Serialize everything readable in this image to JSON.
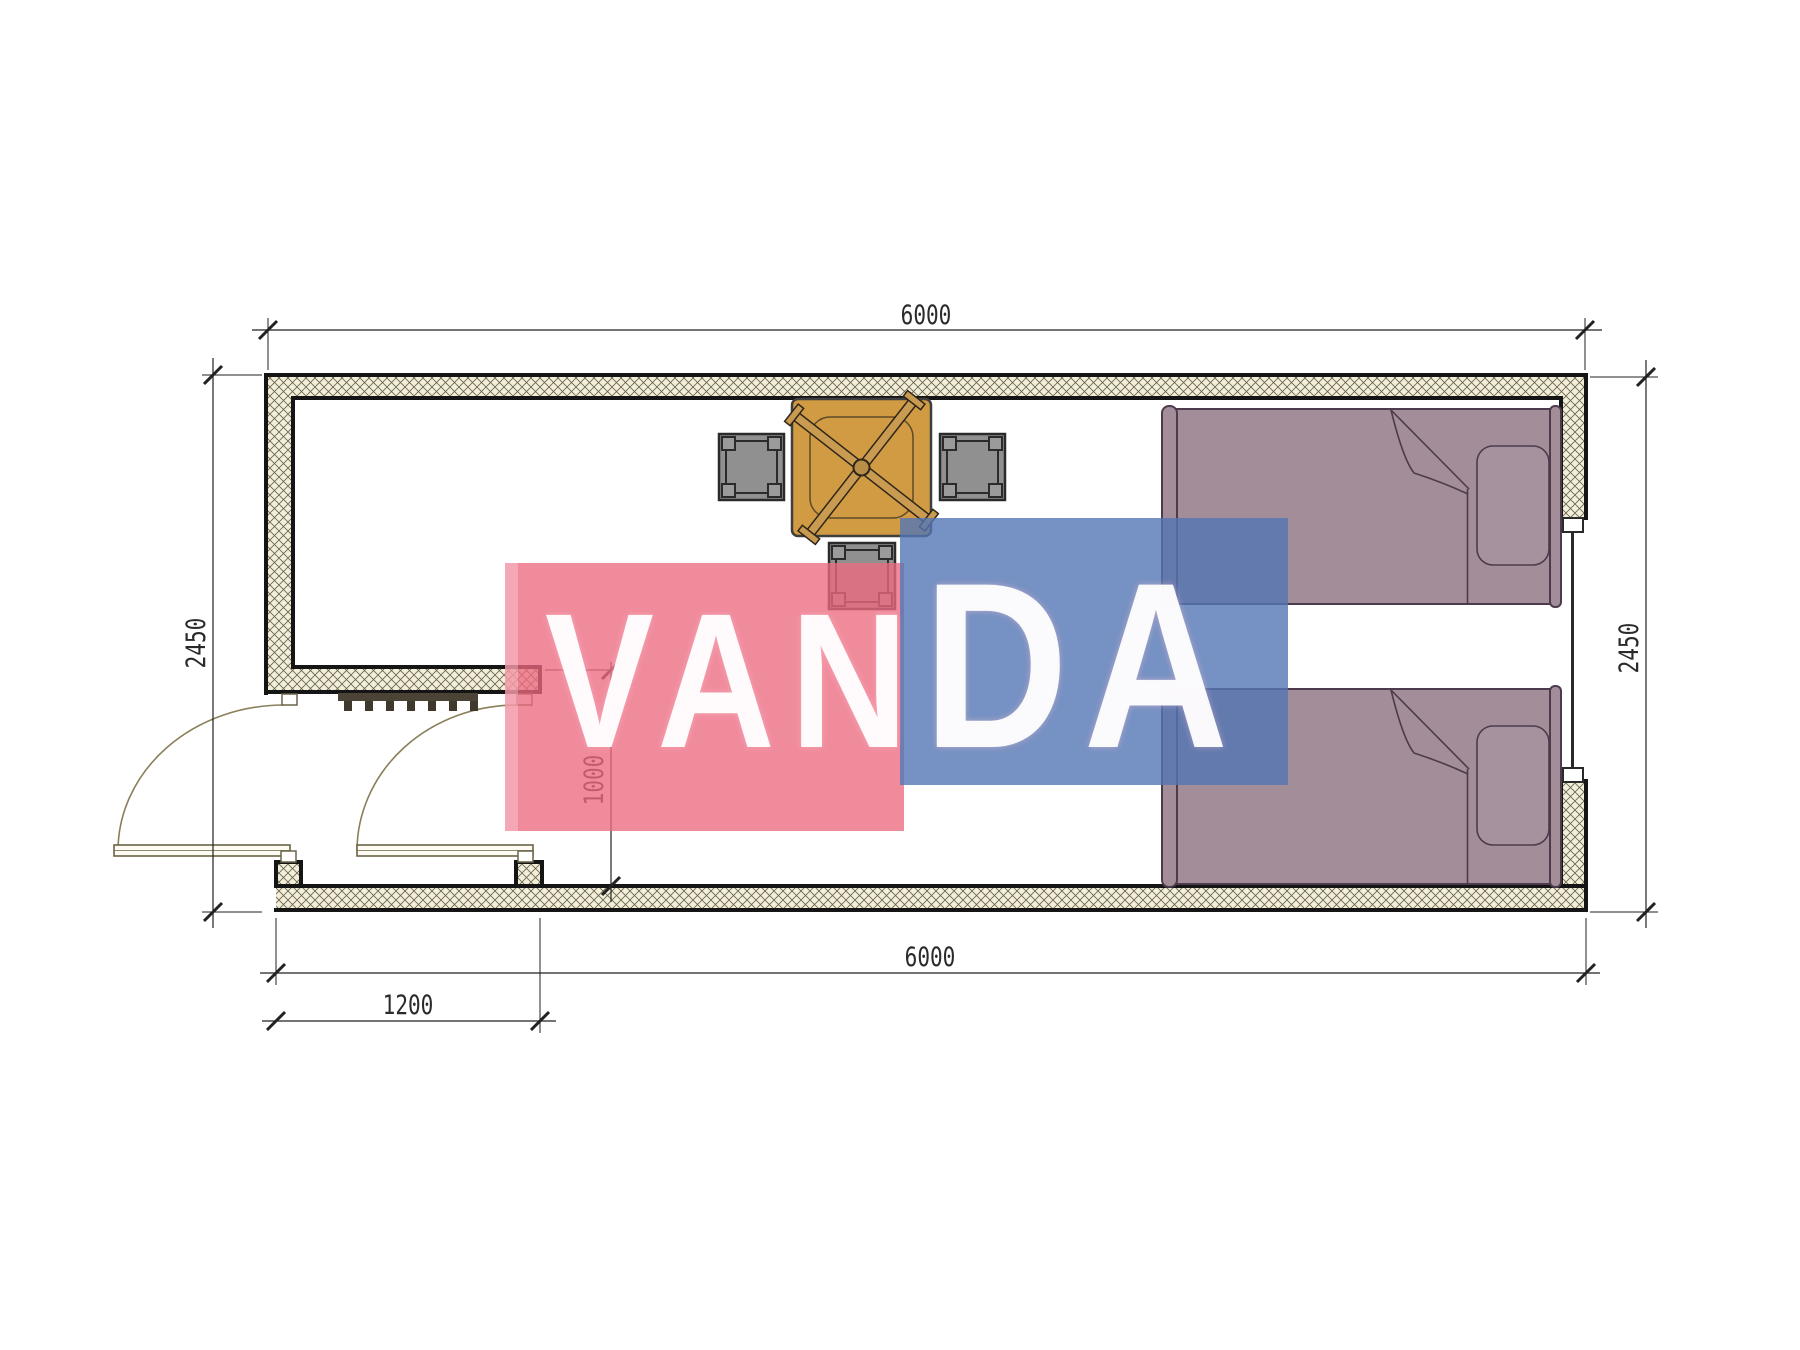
{
  "plan": {
    "dimensions": {
      "overall_width_top": "6000",
      "overall_width_bottom": "6000",
      "overall_depth_left": "2450",
      "overall_depth_right": "2450",
      "entry_bay_width": "1200",
      "entry_bay_depth": "1000"
    },
    "colors": {
      "wall_hatch_bg": "#f1eedc",
      "wall_hatch_line": "#6a6245",
      "wall_outline": "#151515",
      "table_fill": "#d09b42",
      "stool_fill": "#909090",
      "bed_fill": "#a28d99",
      "bed_outline": "#4c3b4c",
      "door_line": "#8a7f5a",
      "dimension_line": "#222222"
    },
    "furniture_counts": {
      "beds": 2,
      "stools": 3,
      "tables": 1,
      "door_leaves": 2,
      "windows": 1
    }
  },
  "watermark": {
    "text": "VANDA",
    "segments": [
      "VAN",
      "DA"
    ],
    "red_color": "#ec6a80",
    "blue_color": "#5476b4",
    "text_color": "#ffffff"
  }
}
